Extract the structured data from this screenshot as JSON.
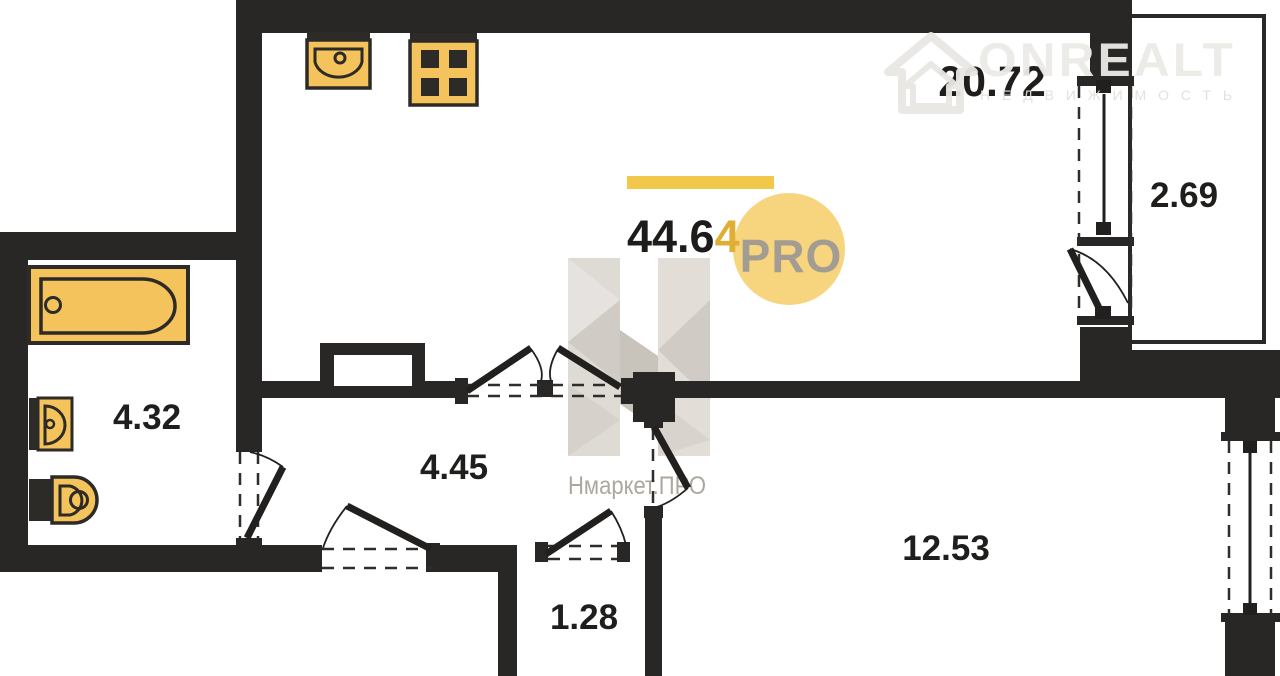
{
  "branding": {
    "onrealt_name": "ONREALT",
    "onrealt_subtitle": "НЕДВИЖИМОСТЬ",
    "nmarket_watermark": "Нмаркет.ПРО",
    "pro_badge": "PRO"
  },
  "plan": {
    "total_area": {
      "full": "44.64",
      "main": "44.6",
      "accent": "4"
    },
    "rooms": [
      {
        "id": "living-kitchen",
        "area": "20.72"
      },
      {
        "id": "balcony",
        "area": "2.69"
      },
      {
        "id": "bathroom",
        "area": "4.32"
      },
      {
        "id": "hallway",
        "area": "4.45"
      },
      {
        "id": "bedroom",
        "area": "12.53"
      },
      {
        "id": "closet",
        "area": "1.28"
      }
    ],
    "icons": [
      "kitchen-sink-icon",
      "stove-icon",
      "bathtub-icon",
      "washbasin-icon",
      "toilet-icon",
      "house-logo-icon",
      "pro-badge"
    ],
    "colors": {
      "wall": "#282725",
      "accent_yellow": "#F2C84B",
      "accent_yellow_dark": "#DFAE35",
      "fixture_yellow": "#F5C35B",
      "pro_circle": "#F7D57E",
      "pro_text": "#A39C93",
      "watermark_gray": "#ada79e",
      "logo_gray": "#eceae6"
    }
  }
}
